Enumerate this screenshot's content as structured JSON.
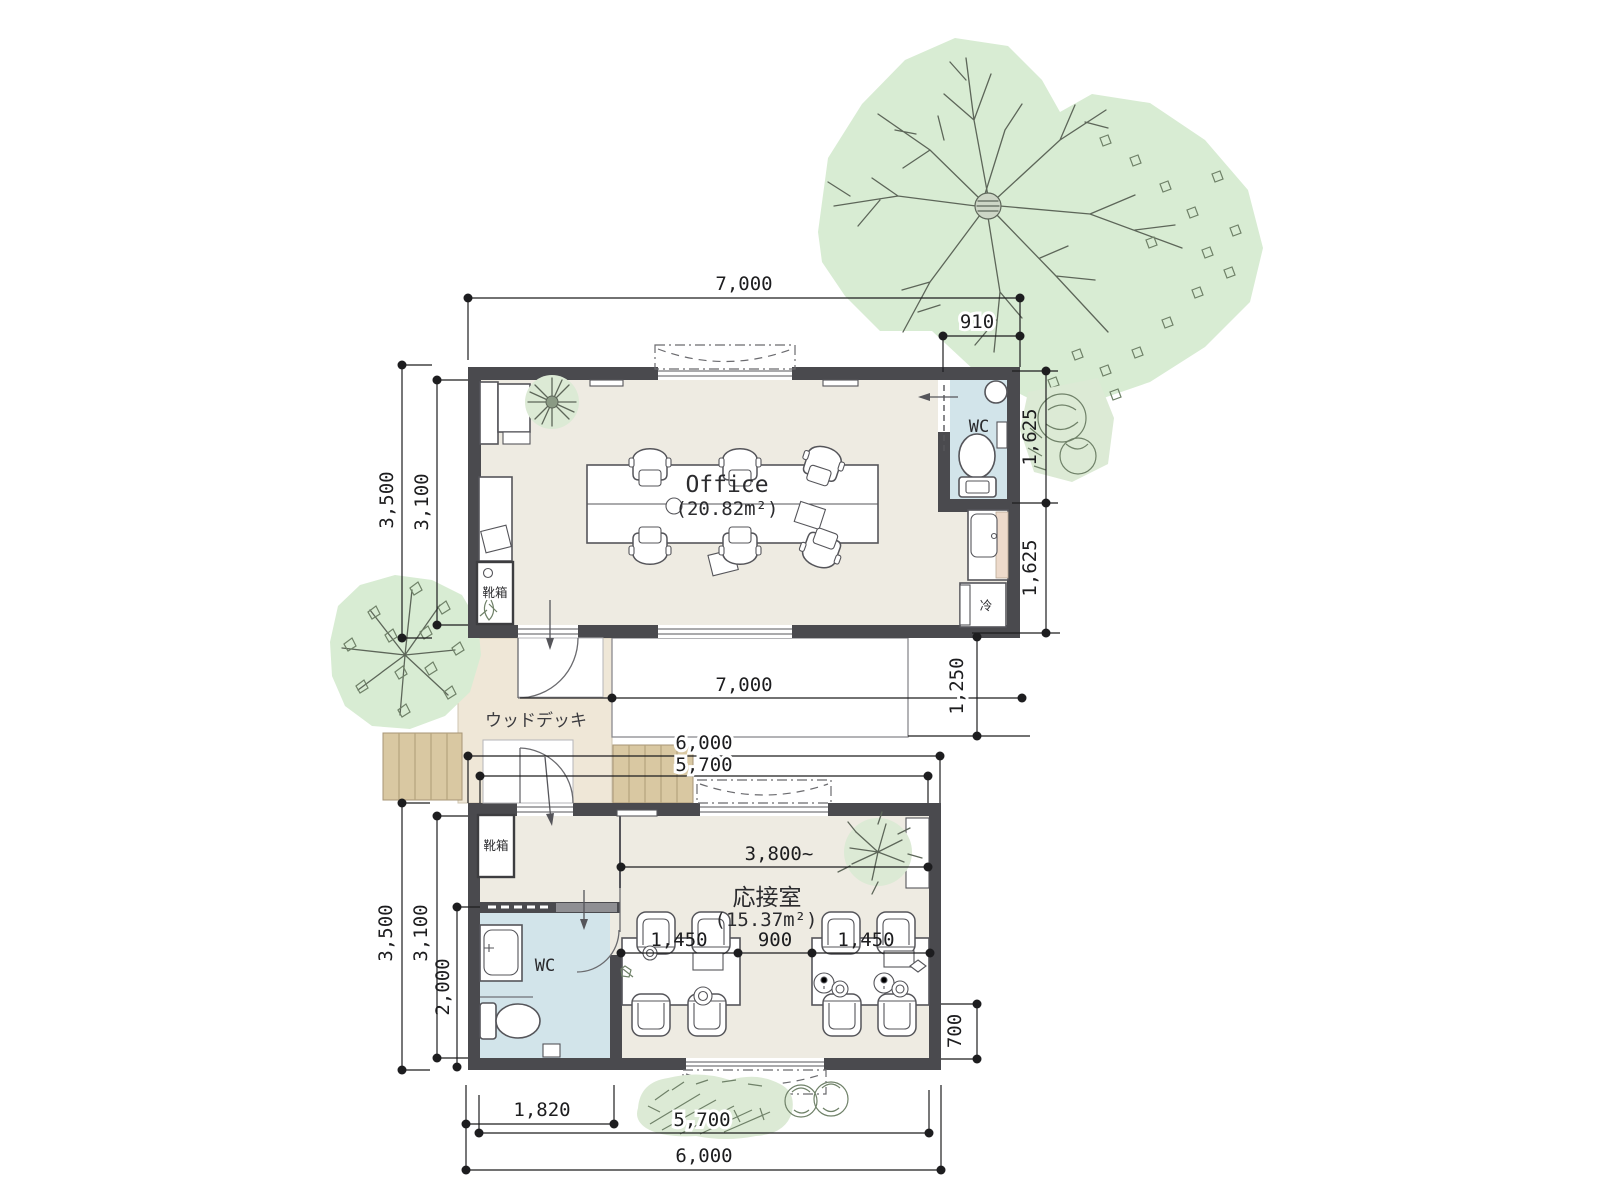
{
  "office": {
    "name": "Office",
    "area": "(20.82m²)",
    "wc": "WC",
    "shoebox": "靴箱",
    "fridge": "冷",
    "dim_width_top": "7,000",
    "dim_wc_width": "910",
    "dim_depth_outer": "3,500",
    "dim_depth_inner": "3,100",
    "dim_right_upper": "1,625",
    "dim_right_lower": "1,625"
  },
  "deck": {
    "name": "ウッドデッキ",
    "dim_width": "7,000",
    "dim_depth": "1,250",
    "dim_lower_outer": "6,000",
    "dim_lower_inner": "5,700"
  },
  "reception": {
    "name": "応接室",
    "area": "(15.37m²)",
    "wc": "WC",
    "shoebox": "靴箱",
    "dim_interior_width": "3,800~",
    "dim_table_left": "1,450",
    "dim_table_gap": "900",
    "dim_table_right": "1,450",
    "dim_depth_outer": "3,500",
    "dim_depth_inner": "3,100",
    "dim_wc_depth": "2,000",
    "dim_right_lower": "700",
    "dim_bottom_left": "1,820",
    "dim_bottom_inner": "5,700",
    "dim_bottom_outer": "6,000"
  },
  "colors": {
    "wall": "#4a4a4e",
    "floor": "#eeebe2",
    "wc_floor": "#d2e4ea",
    "deck": "#efe7d7",
    "steps": "#d9c8a2",
    "tree": "#d8ecd3",
    "counter": "#eddacb"
  }
}
